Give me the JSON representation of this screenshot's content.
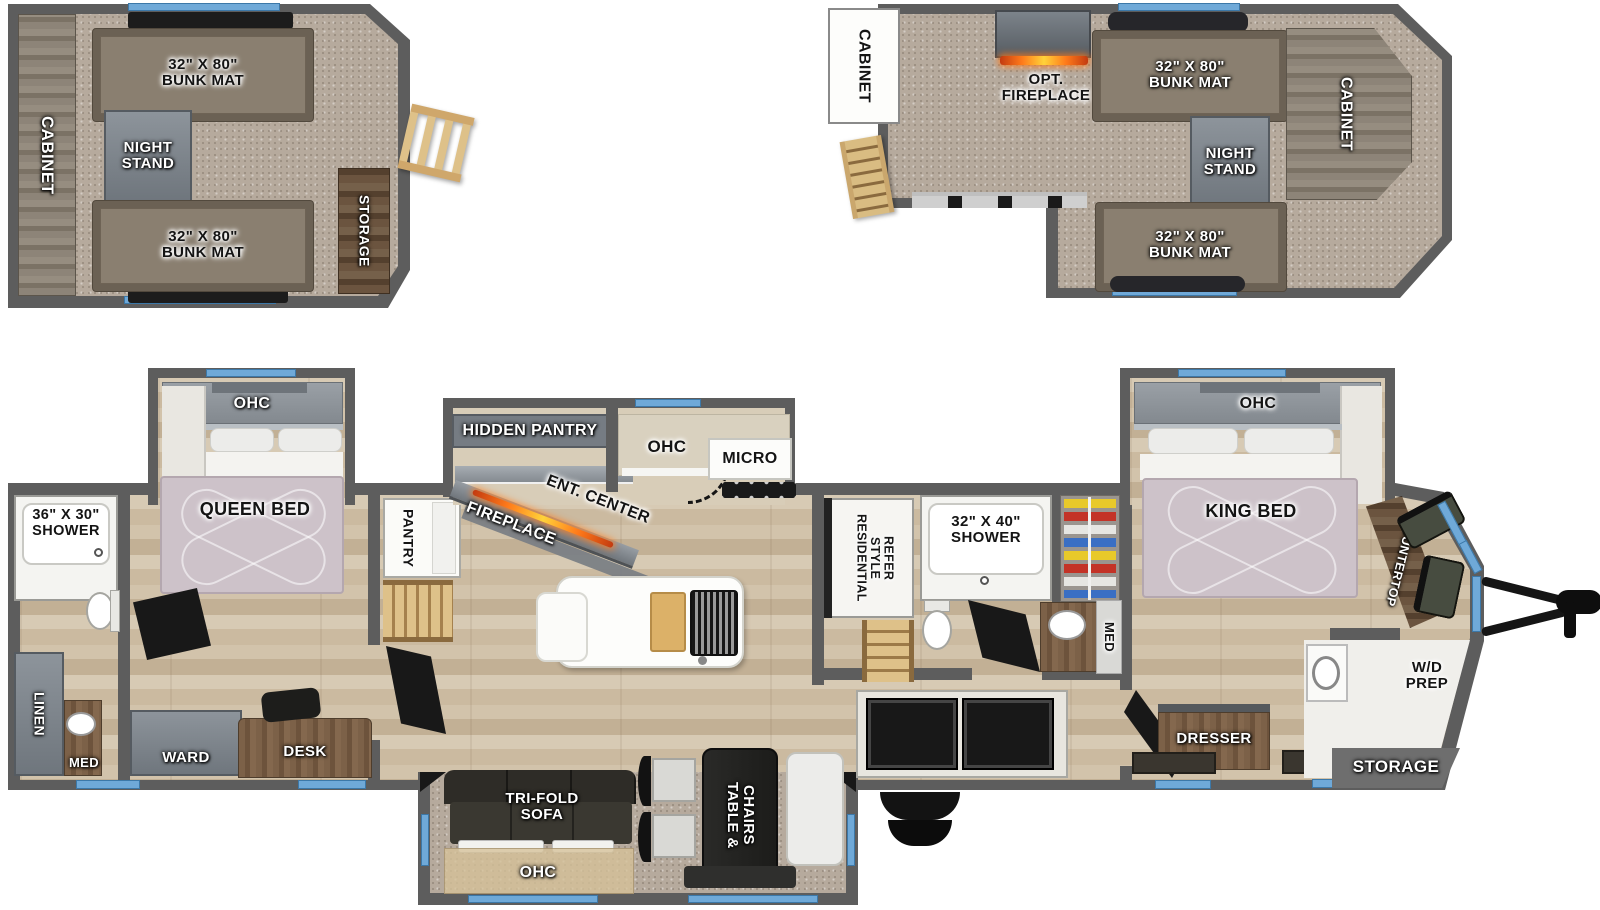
{
  "loft1": {
    "cabinet": "CABINET",
    "bunk_top": "32\" X 80\"\nBUNK MAT",
    "night_stand": "NIGHT\nSTAND",
    "bunk_bottom": "32\" X 80\"\nBUNK MAT",
    "storage": "STORAGE"
  },
  "loft2": {
    "cabinet_left": "CABINET",
    "opt_fireplace": "OPT. FIREPLACE",
    "bunk_top": "32\" X 80\"\nBUNK MAT",
    "night_stand": "NIGHT\nSTAND",
    "cabinet_right": "CABINET",
    "bunk_bottom": "32\" X 80\"\nBUNK MAT"
  },
  "main": {
    "shower_front": "36\" X 30\"\nSHOWER",
    "linen": "LINEN",
    "med_front": "MED",
    "ohc_queen": "OHC",
    "queen_bed": "QUEEN BED",
    "ward": "WARD",
    "desk": "DESK",
    "pantry": "PANTRY",
    "hidden_pantry": "HIDDEN PANTRY",
    "ent_center": "ENT. CENTER",
    "fireplace": "FIREPLACE",
    "ohc_kitchen": "OHC",
    "micro": "MICRO",
    "tri_fold_sofa": "TRI-FOLD\nSOFA",
    "ohc_sofa": "OHC",
    "table_chairs": "TABLE &\nCHAIRS",
    "refer": "RESIDENTIAL\nSTYLE\nREFER",
    "shower_mid": "32\" X 40\"\nSHOWER",
    "med_mid": "MED",
    "ohc_king": "OHC",
    "king_bed": "KING BED",
    "dresser": "DRESSER",
    "countertop": "COUNTERTOP",
    "wd_prep": "W/D\nPREP",
    "storage": "STORAGE"
  },
  "colors": {
    "window_blue": "#6fa9d8",
    "wall_grey": "#5d5d5d",
    "flame_orange": "#ff7a1a",
    "wood_floor": "#cfc1a9",
    "carpet": "#b6aa9d",
    "bed_fabric": "#cdc2c9",
    "dark_furniture": "#23221f"
  }
}
